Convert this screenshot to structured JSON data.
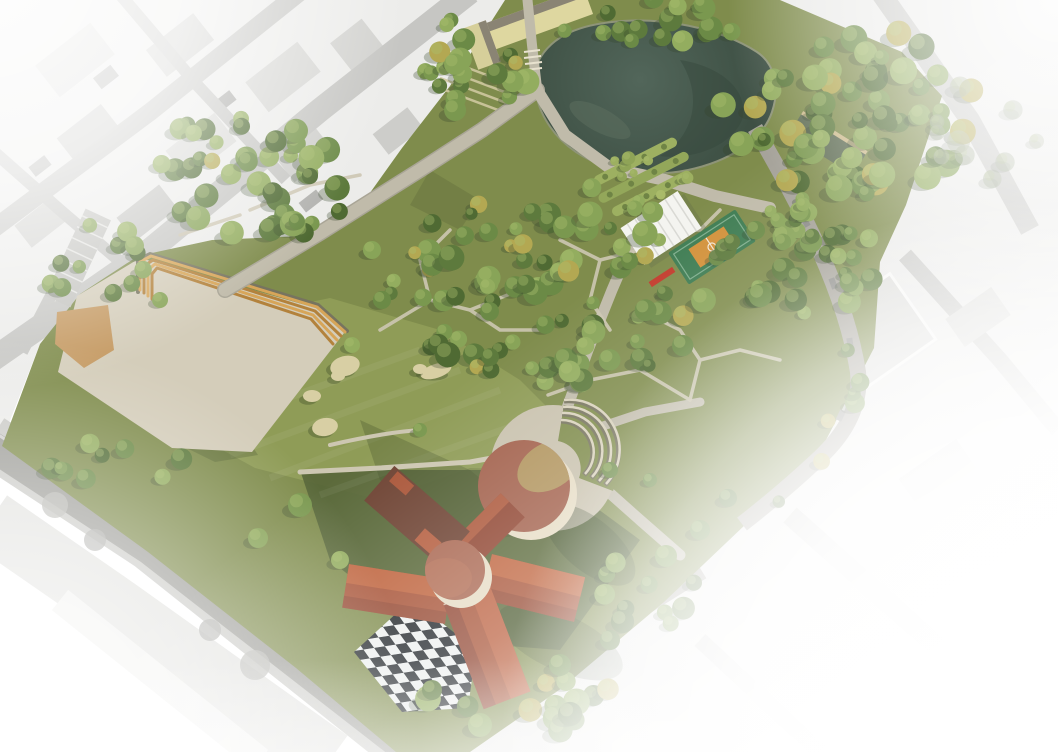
{
  "scene": {
    "kind": "aerial-architectural-masterplan-render",
    "features": [
      "grayscale-city-context",
      "park-grounds",
      "pond",
      "event-plaza",
      "wooden-amphitheater-steps",
      "sand-pit",
      "great-lawn",
      "boulders",
      "formal-garden",
      "white-canopy-court",
      "sports-court",
      "ne-service-building",
      "visitor-building",
      "circular-plaza",
      "amphitheater-steps",
      "pinwheel-museum-building",
      "round-hall",
      "central-drum",
      "checkerboard-plaza",
      "path-network",
      "perimeter-road",
      "tree-canopy",
      "white-vignette"
    ],
    "palette": {
      "white": "#ffffff",
      "city_base_left": "#ececea",
      "city_base_right": "#ebebe9",
      "city_road": "#c6c6c3",
      "city_road_dark": "#9c9c97",
      "lawn_base": "#7f8c4c",
      "lawn_light": "#8f9c57",
      "lawn_dark": "#566539",
      "lawn_shadow": "#3d4a28",
      "pond_light": "#52665a",
      "pond_dark": "#3c4e42",
      "plaza_sand": "#d4cdba",
      "sand_tan": "#c59a63",
      "pavement": "#c9c2ae",
      "path": "#c0bbaa",
      "wood_step": "#d7a558",
      "roof_bright": "#c1663f",
      "roof_mid": "#a85438",
      "roof_deep": "#8f4430",
      "roof_dark": "#6e4333",
      "hall_roof": "#a2604b",
      "hall_tan": "#b29a5f",
      "drum_roof": "#aa6852",
      "wall_cream": "#e6dcc4",
      "checker_dark": "#22272b",
      "checker_light": "#edf0ef",
      "court_green": "#3e7c52",
      "court_orange": "#d2913a",
      "canopy_white": "#f4f4f0",
      "building_yellow": "#ded7a0",
      "building_yellow_roof": "#8a8474",
      "building_green_roof": "#5d6b52",
      "stone": "#d8cfa4"
    },
    "tree_palette": {
      "normal": [
        "#4f6a33",
        "#5d7a3d",
        "#6b8a46",
        "#7a984f",
        "#88a458",
        "#93ad5f"
      ],
      "light": [
        "#9db061",
        "#a9ba68",
        "#8fa457"
      ],
      "faded": [
        "#9aa58a",
        "#a8b096",
        "#8f9c80"
      ],
      "autumn": "#b3a852",
      "highlight": "#a9bd6d",
      "shadow": "#35442a"
    },
    "tree_clusters": [
      {
        "name": "grove-north-entrance",
        "mode": "ellipse",
        "cx": 470,
        "cy": 62,
        "rx": 62,
        "ry": 50,
        "n": 20,
        "rmin": 7,
        "rmax": 13,
        "palette": "normal"
      },
      {
        "name": "grove-pond-north",
        "mode": "ellipse",
        "cx": 645,
        "cy": 22,
        "rx": 95,
        "ry": 24,
        "n": 16,
        "rmin": 7,
        "rmax": 12,
        "palette": "normal"
      },
      {
        "name": "forest-northeast",
        "mode": "ellipse",
        "cx": 862,
        "cy": 112,
        "rx": 140,
        "ry": 82,
        "n": 62,
        "rmin": 7,
        "rmax": 14,
        "palette": "normal"
      },
      {
        "name": "forest-east",
        "mode": "ellipse",
        "cx": 800,
        "cy": 265,
        "rx": 85,
        "ry": 60,
        "n": 34,
        "rmin": 6,
        "rmax": 12,
        "palette": "normal"
      },
      {
        "name": "forest-central",
        "mode": "ellipse",
        "cx": 555,
        "cy": 285,
        "rx": 165,
        "ry": 100,
        "n": 88,
        "rmin": 6,
        "rmax": 13,
        "palette": "normal"
      },
      {
        "name": "forest-northwest",
        "mode": "ellipse",
        "cx": 255,
        "cy": 175,
        "rx": 105,
        "ry": 68,
        "n": 42,
        "rmin": 7,
        "rmax": 13,
        "palette": "normal"
      },
      {
        "name": "grove-west-edge",
        "mode": "ellipse",
        "cx": 95,
        "cy": 262,
        "rx": 55,
        "ry": 42,
        "n": 12,
        "rmin": 6,
        "rmax": 10,
        "palette": "normal"
      },
      {
        "name": "garden-orchard",
        "mode": "ellipse",
        "cx": 645,
        "cy": 170,
        "rx": 55,
        "ry": 28,
        "n": 10,
        "rmin": 4,
        "rmax": 7,
        "palette": "light"
      },
      {
        "name": "street-trees-east",
        "mode": "line",
        "pts": [
          [
            755,
            130
          ],
          [
            805,
            210
          ],
          [
            850,
            300
          ],
          [
            860,
            380
          ],
          [
            820,
            450
          ],
          [
            760,
            515
          ]
        ],
        "n": 16,
        "rmin": 6,
        "rmax": 10,
        "palette": "normal"
      },
      {
        "name": "grove-south",
        "mode": "ellipse",
        "cx": 520,
        "cy": 700,
        "rx": 95,
        "ry": 35,
        "n": 13,
        "rmin": 8,
        "rmax": 14,
        "palette": "normal"
      },
      {
        "name": "grove-southeast",
        "mode": "ellipse",
        "cx": 645,
        "cy": 588,
        "rx": 60,
        "ry": 40,
        "n": 10,
        "rmin": 7,
        "rmax": 12,
        "palette": "normal"
      },
      {
        "name": "row-southwest",
        "mode": "ellipse",
        "cx": 110,
        "cy": 465,
        "rx": 75,
        "ry": 28,
        "n": 9,
        "rmin": 6,
        "rmax": 11,
        "palette": "normal"
      },
      {
        "name": "faded-northeast",
        "mode": "ellipse",
        "cx": 985,
        "cy": 130,
        "rx": 55,
        "ry": 50,
        "n": 10,
        "rmin": 7,
        "rmax": 12,
        "palette": "faded"
      }
    ],
    "single_trees": [
      [
        300,
        505,
        12
      ],
      [
        258,
        538,
        10
      ],
      [
        340,
        560,
        9
      ],
      [
        700,
        530,
        10
      ],
      [
        728,
        498,
        9
      ],
      [
        666,
        556,
        11
      ],
      [
        610,
        640,
        10
      ],
      [
        560,
        665,
        11
      ],
      [
        480,
        725,
        12
      ],
      [
        432,
        690,
        10
      ],
      [
        382,
        300,
        9
      ],
      [
        352,
        345,
        8
      ],
      [
        420,
        430,
        7
      ],
      [
        610,
        470,
        8
      ],
      [
        650,
        480,
        7
      ],
      [
        160,
        300,
        8
      ],
      [
        372,
        250,
        9
      ]
    ],
    "boulders": [
      [
        345,
        366,
        15,
        10,
        -15
      ],
      [
        338,
        376,
        7,
        5,
        0
      ],
      [
        312,
        396,
        9,
        6,
        0
      ],
      [
        325,
        427,
        13,
        9,
        -10
      ],
      [
        436,
        371,
        16,
        7,
        -18
      ],
      [
        420,
        369,
        7,
        5,
        0
      ]
    ]
  }
}
